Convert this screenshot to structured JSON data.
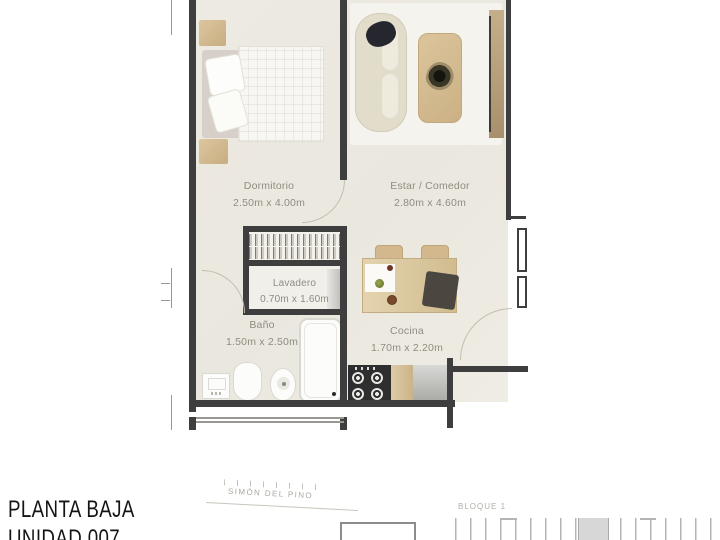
{
  "plan": {
    "rooms": [
      {
        "name": "Dormitorio",
        "dims": "2.50m x 4.00m"
      },
      {
        "name": "Estar / Comedor",
        "dims": "2.80m x 4.60m"
      },
      {
        "name": "Lavadero",
        "dims": "0.70m x 1.60m"
      },
      {
        "name": "Baño",
        "dims": "1.50m x 2.50m"
      },
      {
        "name": "Cocina",
        "dims": "1.70m x 2.20m"
      }
    ]
  },
  "footer": {
    "title_line1": "PLANTA BAJA",
    "title_line2": "UNIDAD 007"
  },
  "site_plan": {
    "street_label": "SIMÓN DEL PINO"
  },
  "key_plan": {
    "block_label": "BLOQUE 1"
  },
  "colors": {
    "wall": "#3e3e3e",
    "floor": "#edeae2",
    "rug": "#f5f3ed",
    "wood": "#d3ba90",
    "muted_text": "#8f8c82",
    "title_text": "#141414",
    "keyplan_gray": "#b4b4b4"
  }
}
